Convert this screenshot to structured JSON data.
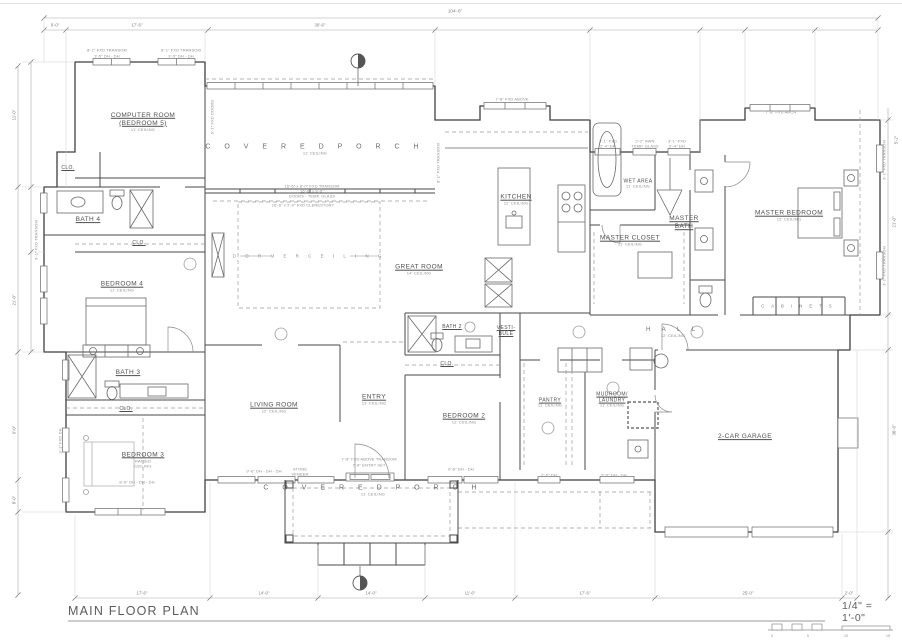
{
  "page": {
    "title": "MAIN FLOOR PLAN",
    "scale_label": "1/4\" = 1'-0\""
  },
  "scale_bar": {
    "ticks": [
      "0",
      "5",
      "10",
      "15"
    ]
  },
  "rooms": {
    "computer_room": {
      "line1": "COMPUTER ROOM",
      "line2": "(BEDROOM 5)",
      "note": "11' CEILING"
    },
    "porch_top": {
      "label": "C O V E R E D   P O R C H",
      "note": "11' CEILING"
    },
    "dormer": {
      "label": "D O R M E R   C E I L I N G"
    },
    "great_room": {
      "label": "GREAT ROOM",
      "note": "14' CEILING"
    },
    "kitchen": {
      "label": "KITCHEN",
      "note": "12' CEILING"
    },
    "wet_area": {
      "label": "WET AREA",
      "note": "11' CEILING"
    },
    "master_bath": {
      "line1": "MASTER",
      "line2": "BATH"
    },
    "master_closet": {
      "label": "MASTER CLOSET",
      "note": "11' CEILING"
    },
    "master_bedroom": {
      "label": "MASTER BEDROOM",
      "note": "12' CEILING"
    },
    "cabinets": {
      "label": "C A B I N E T S"
    },
    "clo_computer": {
      "label": "CLO."
    },
    "bath4": {
      "label": "BATH 4"
    },
    "clo_bed4": {
      "label": "CLO."
    },
    "bedroom4": {
      "label": "BEDROOM 4",
      "note": "11' CEILING"
    },
    "bath3": {
      "label": "BATH 3"
    },
    "clo_hall": {
      "label": "CLO."
    },
    "bedroom3": {
      "label": "BEDROOM 3",
      "note": "RAISED",
      "note2": "CEILING"
    },
    "living": {
      "label": "LIVING ROOM",
      "note": "12' CEILING"
    },
    "entry": {
      "label": "ENTRY",
      "note": "13' CEILING"
    },
    "bath2": {
      "label": "BATH 2"
    },
    "vestibule": {
      "line1": "VESTI-",
      "line2": "BULE"
    },
    "clo_bed2": {
      "label": "CLO."
    },
    "bedroom2": {
      "label": "BEDROOM 2",
      "note": "12' CEILING"
    },
    "pantry": {
      "label": "PANTRY",
      "note": "11' CEILING"
    },
    "mudroom": {
      "line1": "MUDROOM/",
      "line2": "LAUNDRY",
      "note": "11' CEILING"
    },
    "hall": {
      "label": "H A L L",
      "note": "12' CEILING"
    },
    "garage": {
      "label": "2-CAR GARAGE"
    },
    "porch_bottom": {
      "label": "C O V E R E D   P O R C H",
      "note": "11' CEILING"
    }
  },
  "dimensions": {
    "top_overall": "104'-6\"",
    "top_segments": [
      "9'-0\"",
      "17'-6\"",
      "30'-6\""
    ],
    "bottom_segments": [
      "17'-6\"",
      "14'-0\"",
      "14'-0\"",
      "11'-6\"",
      "17'-6\"",
      "25'-0\"",
      "2'-0\""
    ],
    "left_segments": [
      "11'-0\"",
      "21'-0\"",
      "9'-0\"",
      "8'-0\""
    ],
    "right_segments": [
      "5'-2\"",
      "21'-0\"",
      "30'-6\""
    ]
  },
  "annotations": [
    "8'-1\" FXD TRANSOM",
    "3'-5\" DH - DH",
    "8'-1\" FXD TRANSOM",
    "3'-5\" DH - DH",
    "16'-6\" x 8'-0\" FXD TRANSOM",
    "16'-6\" x 8'-0\"",
    "DOORS - TEMP. GLASS",
    "16'-6\" x 2'-0\" FXD CLERESTORY",
    "7'-8\" FXD ABOVE",
    "3'-1\" FXD",
    "2'-4\" DH",
    "2'-2\" AWN",
    "TEMP. GLASS",
    "3'-1\" FXD",
    "2'-4\" DH",
    "7'-8\" FXD ARCH",
    "7'-8\" FXD ABOVE TRANSOM",
    "7'-8\" ENTRY SET",
    "9'-6\" DH - DH - DH",
    "STONE",
    "VENEER",
    "6'-6\" DH - DH",
    "2'-5\" DH",
    "5'-5\" DH - DH",
    "8'-6\" DH - DH - DH",
    "9'-1\" FXD DOORS",
    "3'-1\" FXD TRANSOM",
    "3'-1\" FXD TRANSOM",
    "8'-1\" FXD TRANSOM",
    "3'-1\" FXD DH",
    "9'-1\" FXD TRANSOM"
  ]
}
